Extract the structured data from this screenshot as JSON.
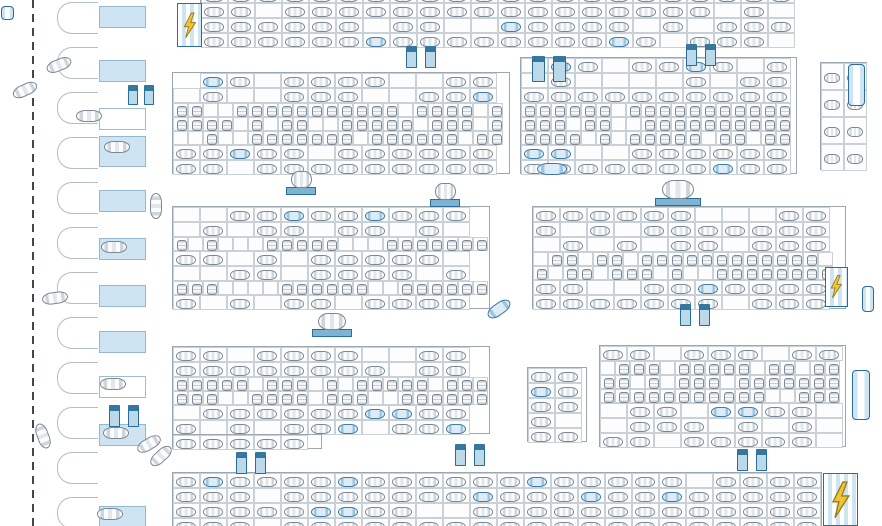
{
  "meta": {
    "description": "Parking lot floor plan drawing, top view, no visible text labels",
    "canvas": {
      "width": 882,
      "height": 526,
      "background": "#ffffff"
    }
  },
  "palette": {
    "block_border": "#9aa6b0",
    "cell_border": "#c9d1d8",
    "car_outline": "#7c8792",
    "car_detail": "#cfd6db",
    "blue_accent": "#2a6d99",
    "blue_fill_light": "#cfe4f2",
    "blue_fill_mid": "#9ec6dd",
    "ev_yellow": "#f0c437",
    "road_dash": "#41474c"
  },
  "road": {
    "centerline_x": 32,
    "dash_length": 8,
    "dash_gap": 6
  },
  "left_strip": {
    "outer_bays": {
      "x": 57,
      "w": 41,
      "h": 32,
      "ys": [
        2,
        47,
        92,
        137,
        182,
        227,
        272,
        317,
        362,
        407,
        452,
        497
      ]
    },
    "inner_bays": {
      "x": 99,
      "w": 47,
      "h": 22,
      "items": [
        {
          "y": 6,
          "blue": true
        },
        {
          "y": 60,
          "blue": true
        },
        {
          "y": 108,
          "blue": false
        },
        {
          "y": 136,
          "blue": true,
          "h": 31
        },
        {
          "y": 190,
          "blue": true
        },
        {
          "y": 238,
          "blue": true
        },
        {
          "y": 285,
          "blue": true
        },
        {
          "y": 331,
          "blue": true
        },
        {
          "y": 376,
          "blue": false
        },
        {
          "y": 424,
          "blue": true
        },
        {
          "y": 506,
          "blue": true
        }
      ]
    }
  },
  "blocks": [
    {
      "id": "A1",
      "x": 200,
      "y": -13,
      "w": 594,
      "rows": [
        "h",
        "h",
        "h",
        "h"
      ],
      "occ": 0.82,
      "seed": 7
    },
    {
      "id": "B1",
      "x": 172,
      "y": 72,
      "w": 338,
      "rows": [
        "h",
        "h",
        "v",
        "v",
        "v",
        "h",
        "h"
      ],
      "occ": 0.78,
      "seed": 11,
      "indent": {
        "0": 1
      }
    },
    {
      "id": "B2",
      "x": 520,
      "y": 57,
      "w": 277,
      "rows": [
        "h",
        "h",
        "h",
        "v",
        "v",
        "v",
        "h",
        "h"
      ],
      "occ": 0.84,
      "seed": 23
    },
    {
      "id": "B3",
      "x": 820,
      "y": 62,
      "w": 47,
      "rows": [
        "h",
        "h",
        "h",
        "h"
      ],
      "occ": 1.0,
      "seed": 29,
      "cellW": 23,
      "cellH": 27
    },
    {
      "id": "C1",
      "x": 172,
      "y": 206,
      "w": 318,
      "rows": [
        "h",
        "h",
        "v",
        "h",
        "h",
        "v",
        "h"
      ],
      "occ": 0.72,
      "seed": 31
    },
    {
      "id": "C2",
      "x": 532,
      "y": 206,
      "w": 314,
      "rows": [
        "h",
        "h",
        "h",
        "v",
        "v",
        "h",
        "h"
      ],
      "occ": 0.8,
      "seed": 41
    },
    {
      "id": "D1",
      "x": 172,
      "y": 346,
      "w": 318,
      "rows": [
        "h",
        "h",
        "v",
        "v",
        "h",
        "h"
      ],
      "occ": 0.8,
      "seed": 51
    },
    {
      "id": "D1b",
      "x": 172,
      "y": 434,
      "w": 150,
      "rows": [
        "h"
      ],
      "occ": 0.7,
      "seed": 53
    },
    {
      "id": "D3",
      "x": 527,
      "y": 367,
      "w": 60,
      "rows": [
        "h",
        "h",
        "h",
        "h",
        "h"
      ],
      "occ": 0.92,
      "seed": 57
    },
    {
      "id": "D2",
      "x": 599,
      "y": 345,
      "w": 247,
      "rows": [
        "h",
        "v",
        "v",
        "v",
        "h",
        "h",
        "h"
      ],
      "occ": 0.82,
      "seed": 61
    },
    {
      "id": "E1",
      "x": 172,
      "y": 472,
      "w": 650,
      "rows": [
        "h",
        "h",
        "h",
        "h"
      ],
      "occ": 0.92,
      "seed": 71
    }
  ],
  "cell_defaults": {
    "h": {
      "w": 27,
      "h": 15
    },
    "v": {
      "w": 15,
      "h": 14
    }
  },
  "ev_stations": [
    {
      "x": 177,
      "y": 3,
      "w": 25,
      "h": 44
    },
    {
      "x": 825,
      "y": 267,
      "w": 23,
      "h": 40
    },
    {
      "x": 823,
      "y": 473,
      "w": 35,
      "h": 53
    }
  ],
  "stair_icons": [
    {
      "x": 406,
      "y": 46
    },
    {
      "x": 686,
      "y": 44
    },
    {
      "x": 532,
      "y": 56,
      "w": 34,
      "h": 26
    },
    {
      "x": 128,
      "y": 85,
      "w": 26,
      "h": 20
    },
    {
      "x": 236,
      "y": 452
    },
    {
      "x": 455,
      "y": 444
    },
    {
      "x": 737,
      "y": 449
    },
    {
      "x": 680,
      "y": 304
    },
    {
      "x": 109,
      "y": 405
    }
  ],
  "entrance_icons": [
    {
      "x": 286,
      "y": 171,
      "w": 30,
      "h": 24
    },
    {
      "x": 430,
      "y": 183,
      "w": 30,
      "h": 24
    },
    {
      "x": 655,
      "y": 180,
      "w": 46,
      "h": 26
    },
    {
      "x": 312,
      "y": 313,
      "w": 40,
      "h": 24
    }
  ],
  "edge_icons": [
    {
      "x": 848,
      "y": 64,
      "w": 17,
      "h": 42
    },
    {
      "x": 862,
      "y": 286,
      "w": 12,
      "h": 26
    },
    {
      "x": 852,
      "y": 370,
      "w": 18,
      "h": 50
    },
    {
      "x": 1,
      "y": 6,
      "w": 13,
      "h": 14
    }
  ],
  "loose_cars": [
    {
      "x": 12,
      "y": 84,
      "a": -25
    },
    {
      "x": 46,
      "y": 59,
      "a": -22
    },
    {
      "x": 42,
      "y": 292,
      "a": -8
    },
    {
      "x": 30,
      "y": 430,
      "a": 70
    },
    {
      "x": 76,
      "y": 110,
      "a": 0
    },
    {
      "x": 104,
      "y": 141,
      "a": 0
    },
    {
      "x": 101,
      "y": 241,
      "a": 0
    },
    {
      "x": 100,
      "y": 378,
      "a": 0
    },
    {
      "x": 103,
      "y": 427,
      "a": 0
    },
    {
      "x": 136,
      "y": 438,
      "a": -30
    },
    {
      "x": 148,
      "y": 450,
      "a": -42
    },
    {
      "x": 97,
      "y": 508,
      "a": 0
    },
    {
      "x": 143,
      "y": 200,
      "a": 90
    },
    {
      "x": 537,
      "y": 163,
      "a": 0,
      "c": "blue",
      "w": 30
    },
    {
      "x": 486,
      "y": 303,
      "a": -35,
      "c": "blue"
    }
  ]
}
